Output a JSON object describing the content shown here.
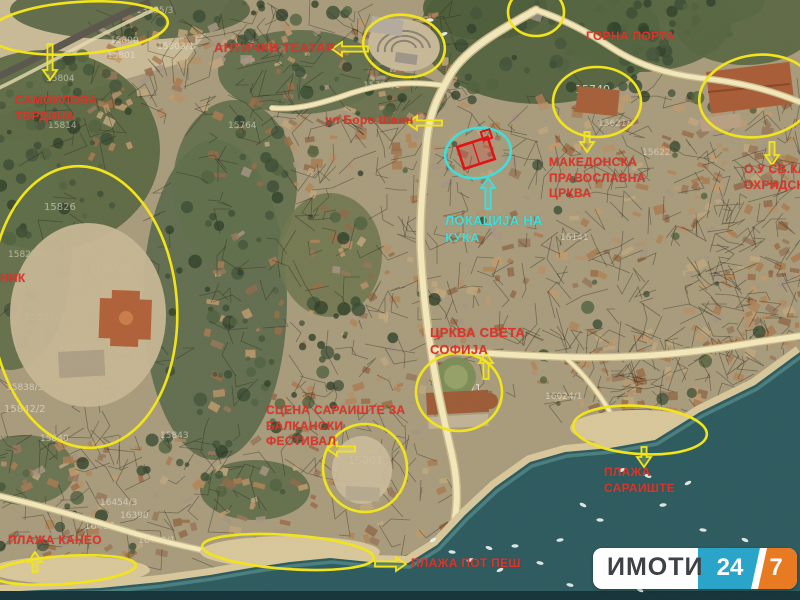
{
  "map": {
    "colors": {
      "annotation_yellow": "#f2e41c",
      "annotation_red": "#df342a",
      "annotation_cyan": "#3fdeda",
      "highlight_box_red": "#e01414",
      "road": "#f3e8ba",
      "water": "#2c5a5e",
      "land": "#a89b7c"
    },
    "region_labels": [
      {
        "name": "samoilova-tvrdina-label",
        "x": 15,
        "y": 93,
        "size": 12,
        "color": "red",
        "lines": [
          "САМОИЛОВА",
          "ТВРДИНА"
        ]
      },
      {
        "name": "antichki-teatar-label",
        "x": 214,
        "y": 40,
        "size": 13,
        "color": "red",
        "lines": [
          "АНТИЧКИ ТЕАТАР"
        ]
      },
      {
        "name": "gorna-porta-label",
        "x": 586,
        "y": 29,
        "size": 12,
        "color": "red",
        "lines": [
          "ГОРНА ПОРТА"
        ]
      },
      {
        "name": "makedonska-crkva-label",
        "x": 549,
        "y": 155,
        "size": 12,
        "color": "red",
        "lines": [
          "МАКЕДОНСКА",
          "ПРАВОСЛАВНА",
          "ЦРКВА"
        ]
      },
      {
        "name": "ou-sv-kliment-label",
        "x": 744,
        "y": 162,
        "size": 12,
        "color": "red",
        "lines": [
          "О.У СВ.КЛИ",
          "ОХРИДСКИ"
        ]
      },
      {
        "name": "ul-boro-shain-label",
        "x": 325,
        "y": 113,
        "size": 12,
        "color": "red",
        "lines": [
          "ул Боро Шаин"
        ]
      },
      {
        "name": "lokacija-na-kukja-label",
        "x": 445,
        "y": 213,
        "size": 13,
        "color": "cyan",
        "lines": [
          "ЛОКАЦИЈА НА",
          "КУЌА"
        ]
      },
      {
        "name": "crkva-sveta-sofija-label",
        "x": 430,
        "y": 325,
        "size": 13,
        "color": "red",
        "lines": [
          "ЦРКВА СВЕТА",
          "СОФИЈА"
        ]
      },
      {
        "name": "scena-saraiste-label",
        "x": 266,
        "y": 403,
        "size": 12,
        "color": "red",
        "lines": [
          "СЦЕНА САРАИШТЕ ЗА",
          "БАЛКАНСКИ",
          "ФЕСТИВАЛ"
        ]
      },
      {
        "name": "plaosnik-label",
        "x": 0,
        "y": 271,
        "size": 12,
        "color": "red",
        "lines": [
          "НИК"
        ]
      },
      {
        "name": "plaza-kaneo-label",
        "x": 8,
        "y": 533,
        "size": 12,
        "color": "red",
        "lines": [
          "ПЛАЖА КАНЕО"
        ]
      },
      {
        "name": "plaza-pot-pes-label",
        "x": 411,
        "y": 556,
        "size": 12,
        "color": "red",
        "lines": [
          "ПЛАЖА ПОТ ПЕШ"
        ]
      },
      {
        "name": "plaza-saraiste-label",
        "x": 604,
        "y": 465,
        "size": 12,
        "color": "red",
        "lines": [
          "ПЛАЖА",
          "САРАИШТЕ"
        ]
      }
    ],
    "highlight_ellipses": [
      {
        "cx": 78,
        "cy": 28,
        "rx": 90,
        "ry": 26,
        "rot": -4,
        "color": "yellow"
      },
      {
        "cx": 404,
        "cy": 46,
        "rx": 41,
        "ry": 31,
        "rot": 8,
        "color": "yellow"
      },
      {
        "cx": 536,
        "cy": 12,
        "rx": 28,
        "ry": 24,
        "rot": 0,
        "color": "yellow"
      },
      {
        "cx": 597,
        "cy": 102,
        "rx": 44,
        "ry": 35,
        "rot": 0,
        "color": "yellow"
      },
      {
        "cx": 757,
        "cy": 96,
        "rx": 58,
        "ry": 41,
        "rot": -8,
        "color": "yellow"
      },
      {
        "cx": 84,
        "cy": 307,
        "rx": 93,
        "ry": 141,
        "rot": -4,
        "color": "yellow"
      },
      {
        "cx": 459,
        "cy": 392,
        "rx": 43,
        "ry": 39,
        "rot": 0,
        "color": "yellow"
      },
      {
        "cx": 365,
        "cy": 468,
        "rx": 42,
        "ry": 44,
        "rot": 0,
        "color": "yellow"
      },
      {
        "cx": 640,
        "cy": 430,
        "rx": 67,
        "ry": 24,
        "rot": 4,
        "color": "yellow"
      },
      {
        "cx": 288,
        "cy": 552,
        "rx": 86,
        "ry": 17,
        "rot": 4,
        "color": "yellow"
      },
      {
        "cx": 64,
        "cy": 570,
        "rx": 72,
        "ry": 14,
        "rot": -4,
        "color": "yellow"
      },
      {
        "cx": 478,
        "cy": 153,
        "rx": 33,
        "ry": 25,
        "rot": -10,
        "color": "cyan"
      }
    ],
    "annotation_arrows": [
      {
        "x1": 50,
        "y1": 44,
        "x2": 50,
        "y2": 80,
        "color": "yellow"
      },
      {
        "x1": 368,
        "y1": 49,
        "x2": 332,
        "y2": 49,
        "color": "yellow"
      },
      {
        "x1": 442,
        "y1": 123,
        "x2": 407,
        "y2": 123,
        "color": "yellow"
      },
      {
        "x1": 587,
        "y1": 132,
        "x2": 587,
        "y2": 152,
        "color": "yellow"
      },
      {
        "x1": 772,
        "y1": 142,
        "x2": 772,
        "y2": 165,
        "color": "yellow"
      },
      {
        "x1": 486,
        "y1": 379,
        "x2": 486,
        "y2": 353,
        "color": "yellow"
      },
      {
        "x1": 355,
        "y1": 449,
        "x2": 327,
        "y2": 449,
        "color": "yellow"
      },
      {
        "x1": 644,
        "y1": 447,
        "x2": 644,
        "y2": 467,
        "color": "yellow"
      },
      {
        "x1": 375,
        "y1": 564,
        "x2": 406,
        "y2": 564,
        "color": "yellow"
      },
      {
        "x1": 35,
        "y1": 572,
        "x2": 35,
        "y2": 552,
        "color": "yellow"
      },
      {
        "x1": 488,
        "y1": 209,
        "x2": 488,
        "y2": 178,
        "color": "cyan"
      }
    ],
    "house_outline": {
      "cx": 476,
      "cy": 153,
      "w": 32,
      "h": 23,
      "rot": -18
    },
    "parcel_numbers": [
      {
        "text": "15698",
        "x": 388,
        "y": 50,
        "size": 13
      },
      {
        "text": "15740",
        "x": 575,
        "y": 93,
        "size": 11
      },
      {
        "text": "16030/1",
        "x": 436,
        "y": 392,
        "size": 11
      },
      {
        "text": "16001",
        "x": 348,
        "y": 464,
        "size": 11
      },
      {
        "text": "13795/3",
        "x": 136,
        "y": 13,
        "size": 9
      },
      {
        "text": "15800",
        "x": 110,
        "y": 43,
        "size": 9
      },
      {
        "text": "15803/1",
        "x": 157,
        "y": 49,
        "size": 9
      },
      {
        "text": "15801",
        "x": 107,
        "y": 58,
        "size": 9
      },
      {
        "text": "15804",
        "x": 46,
        "y": 81,
        "size": 9
      },
      {
        "text": "15814",
        "x": 48,
        "y": 128,
        "size": 9
      },
      {
        "text": "15826",
        "x": 44,
        "y": 210,
        "size": 10
      },
      {
        "text": "15827/2",
        "x": 8,
        "y": 257,
        "size": 9
      },
      {
        "text": "15835/1",
        "x": 96,
        "y": 271,
        "size": 9
      },
      {
        "text": "15838/1",
        "x": 24,
        "y": 320,
        "size": 10
      },
      {
        "text": "15838/2",
        "x": 58,
        "y": 351,
        "size": 10
      },
      {
        "text": "15838/3",
        "x": 6,
        "y": 390,
        "size": 9
      },
      {
        "text": "15842/2",
        "x": 4,
        "y": 412,
        "size": 10
      },
      {
        "text": "15840",
        "x": 40,
        "y": 441,
        "size": 9
      },
      {
        "text": "15843",
        "x": 160,
        "y": 438,
        "size": 9
      },
      {
        "text": "15764",
        "x": 228,
        "y": 128,
        "size": 9
      },
      {
        "text": "15780/1",
        "x": 363,
        "y": 88,
        "size": 9
      },
      {
        "text": "15621/7",
        "x": 598,
        "y": 126,
        "size": 9
      },
      {
        "text": "15622",
        "x": 642,
        "y": 155,
        "size": 9
      },
      {
        "text": "16141",
        "x": 560,
        "y": 240,
        "size": 9
      },
      {
        "text": "16024/1",
        "x": 545,
        "y": 399,
        "size": 9
      },
      {
        "text": "16055",
        "x": 575,
        "y": 430,
        "size": 9
      },
      {
        "text": "16421",
        "x": 84,
        "y": 529,
        "size": 10
      },
      {
        "text": "16390",
        "x": 120,
        "y": 518,
        "size": 9
      },
      {
        "text": "16454/3",
        "x": 100,
        "y": 505,
        "size": 9
      },
      {
        "text": "16423/1",
        "x": 138,
        "y": 543,
        "size": 9
      }
    ],
    "boats": [
      [
        433,
        540
      ],
      [
        452,
        552
      ],
      [
        470,
        560
      ],
      [
        489,
        548
      ],
      [
        515,
        546
      ],
      [
        500,
        570
      ],
      [
        540,
        563
      ],
      [
        560,
        540
      ],
      [
        583,
        505
      ],
      [
        600,
        520
      ],
      [
        622,
        470
      ],
      [
        648,
        476
      ],
      [
        663,
        505
      ],
      [
        688,
        483
      ],
      [
        703,
        530
      ],
      [
        722,
        560
      ],
      [
        745,
        540
      ],
      [
        760,
        585
      ],
      [
        680,
        560
      ],
      [
        570,
        585
      ],
      [
        610,
        567
      ],
      [
        640,
        590
      ],
      [
        430,
        20
      ],
      [
        444,
        34
      ]
    ]
  },
  "logo": {
    "text": "ИМОТИ",
    "left_number": "24",
    "right_number": "7"
  }
}
